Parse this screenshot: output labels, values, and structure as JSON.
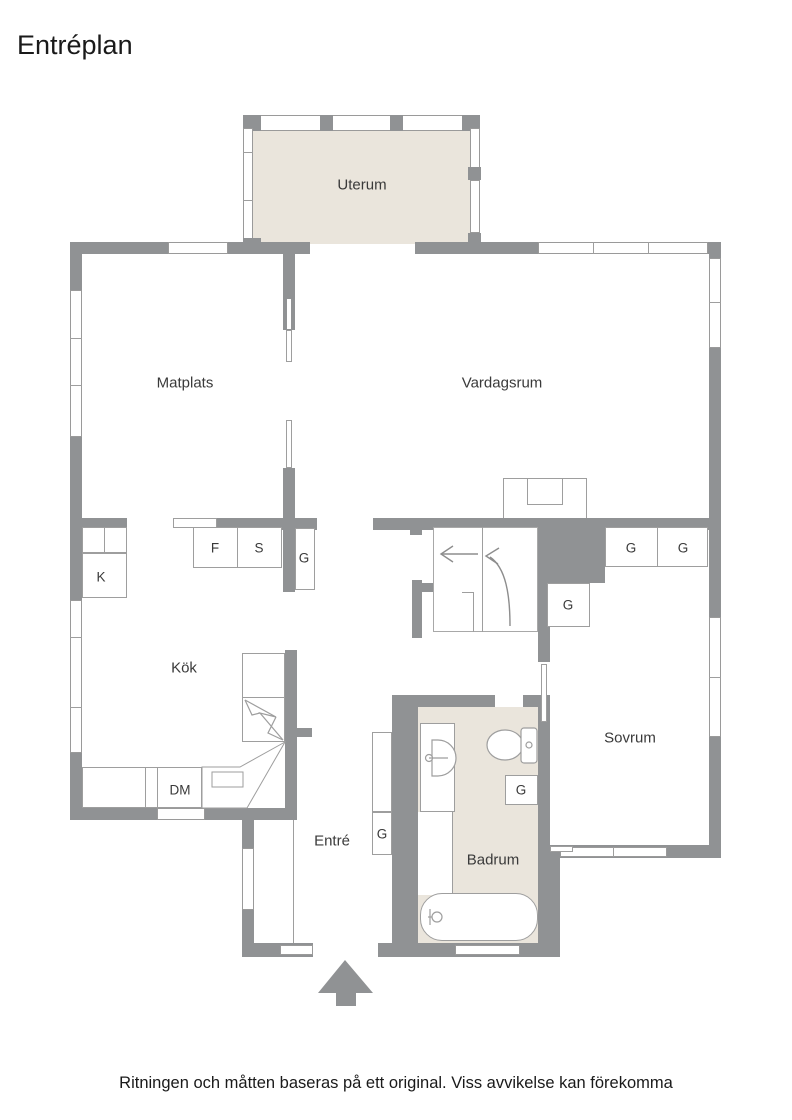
{
  "title": "Entréplan",
  "disclaimer": "Ritningen och måtten baseras på ett original. Viss avvikelse kan förekomma",
  "rooms": {
    "uterum": "Uterum",
    "matplats": "Matplats",
    "vardagsrum": "Vardagsrum",
    "kok": "Kök",
    "sovrum": "Sovrum",
    "entre": "Entré",
    "badrum": "Badrum"
  },
  "fixtures": {
    "fridge": "K",
    "freezer": "F",
    "pantry": "S",
    "dishwasher": "DM",
    "closet": "G"
  },
  "colors": {
    "wall": "#909294",
    "floor_accent": "#eae5dc",
    "line": "#9e9e9e",
    "text": "#3a3a3a"
  }
}
